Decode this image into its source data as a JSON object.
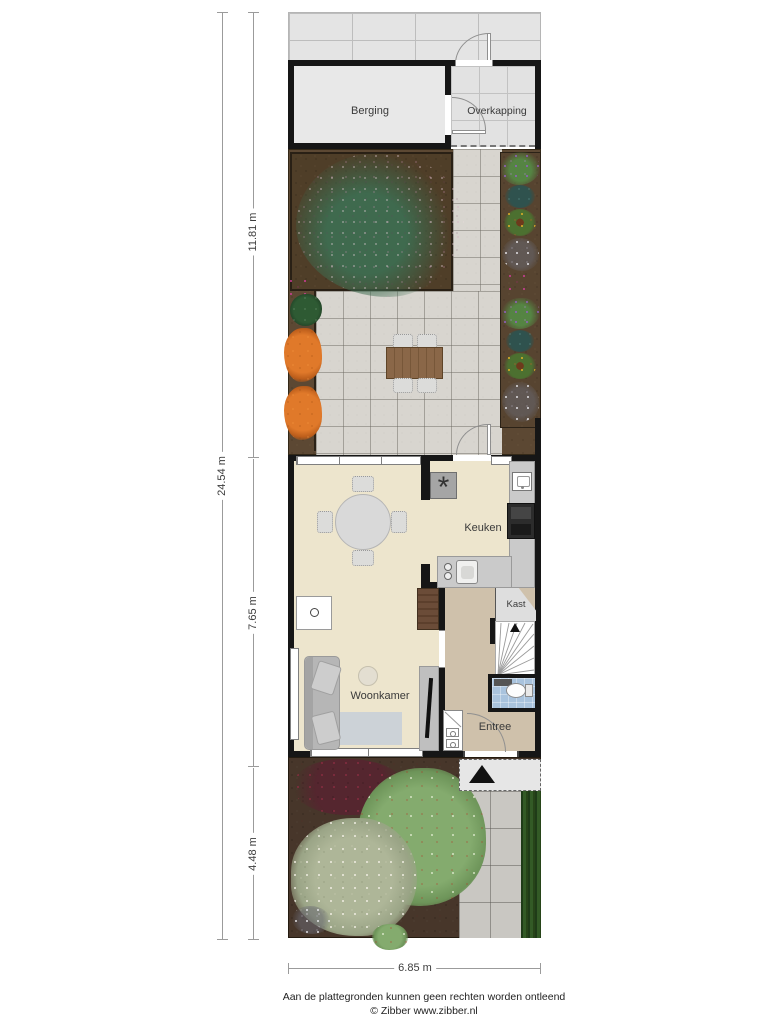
{
  "plan": {
    "rooms": {
      "berging": "Berging",
      "overkapping": "Overkapping",
      "keuken": "Keuken",
      "woonkamer": "Woonkamer",
      "kast": "Kast",
      "entree": "Entree"
    },
    "dimensions": {
      "total": "24.54 m",
      "back_section": "11.81 m",
      "house_section": "7.65 m",
      "front_section": "4.48 m",
      "width": "6.85 m"
    },
    "colors": {
      "wall": "#161616",
      "floor_main": "#ede5cd",
      "floor_hall": "#cfc1ab",
      "bathroom": "#a9c3dd",
      "shed_floor": "#e8e8e8",
      "terrace_tile": "#d8d5cf",
      "soil": "#5c4833"
    }
  },
  "footer": {
    "line1": "Aan de plattegronden kunnen geen rechten worden ontleend",
    "line2": "© Zibber www.zibber.nl"
  }
}
